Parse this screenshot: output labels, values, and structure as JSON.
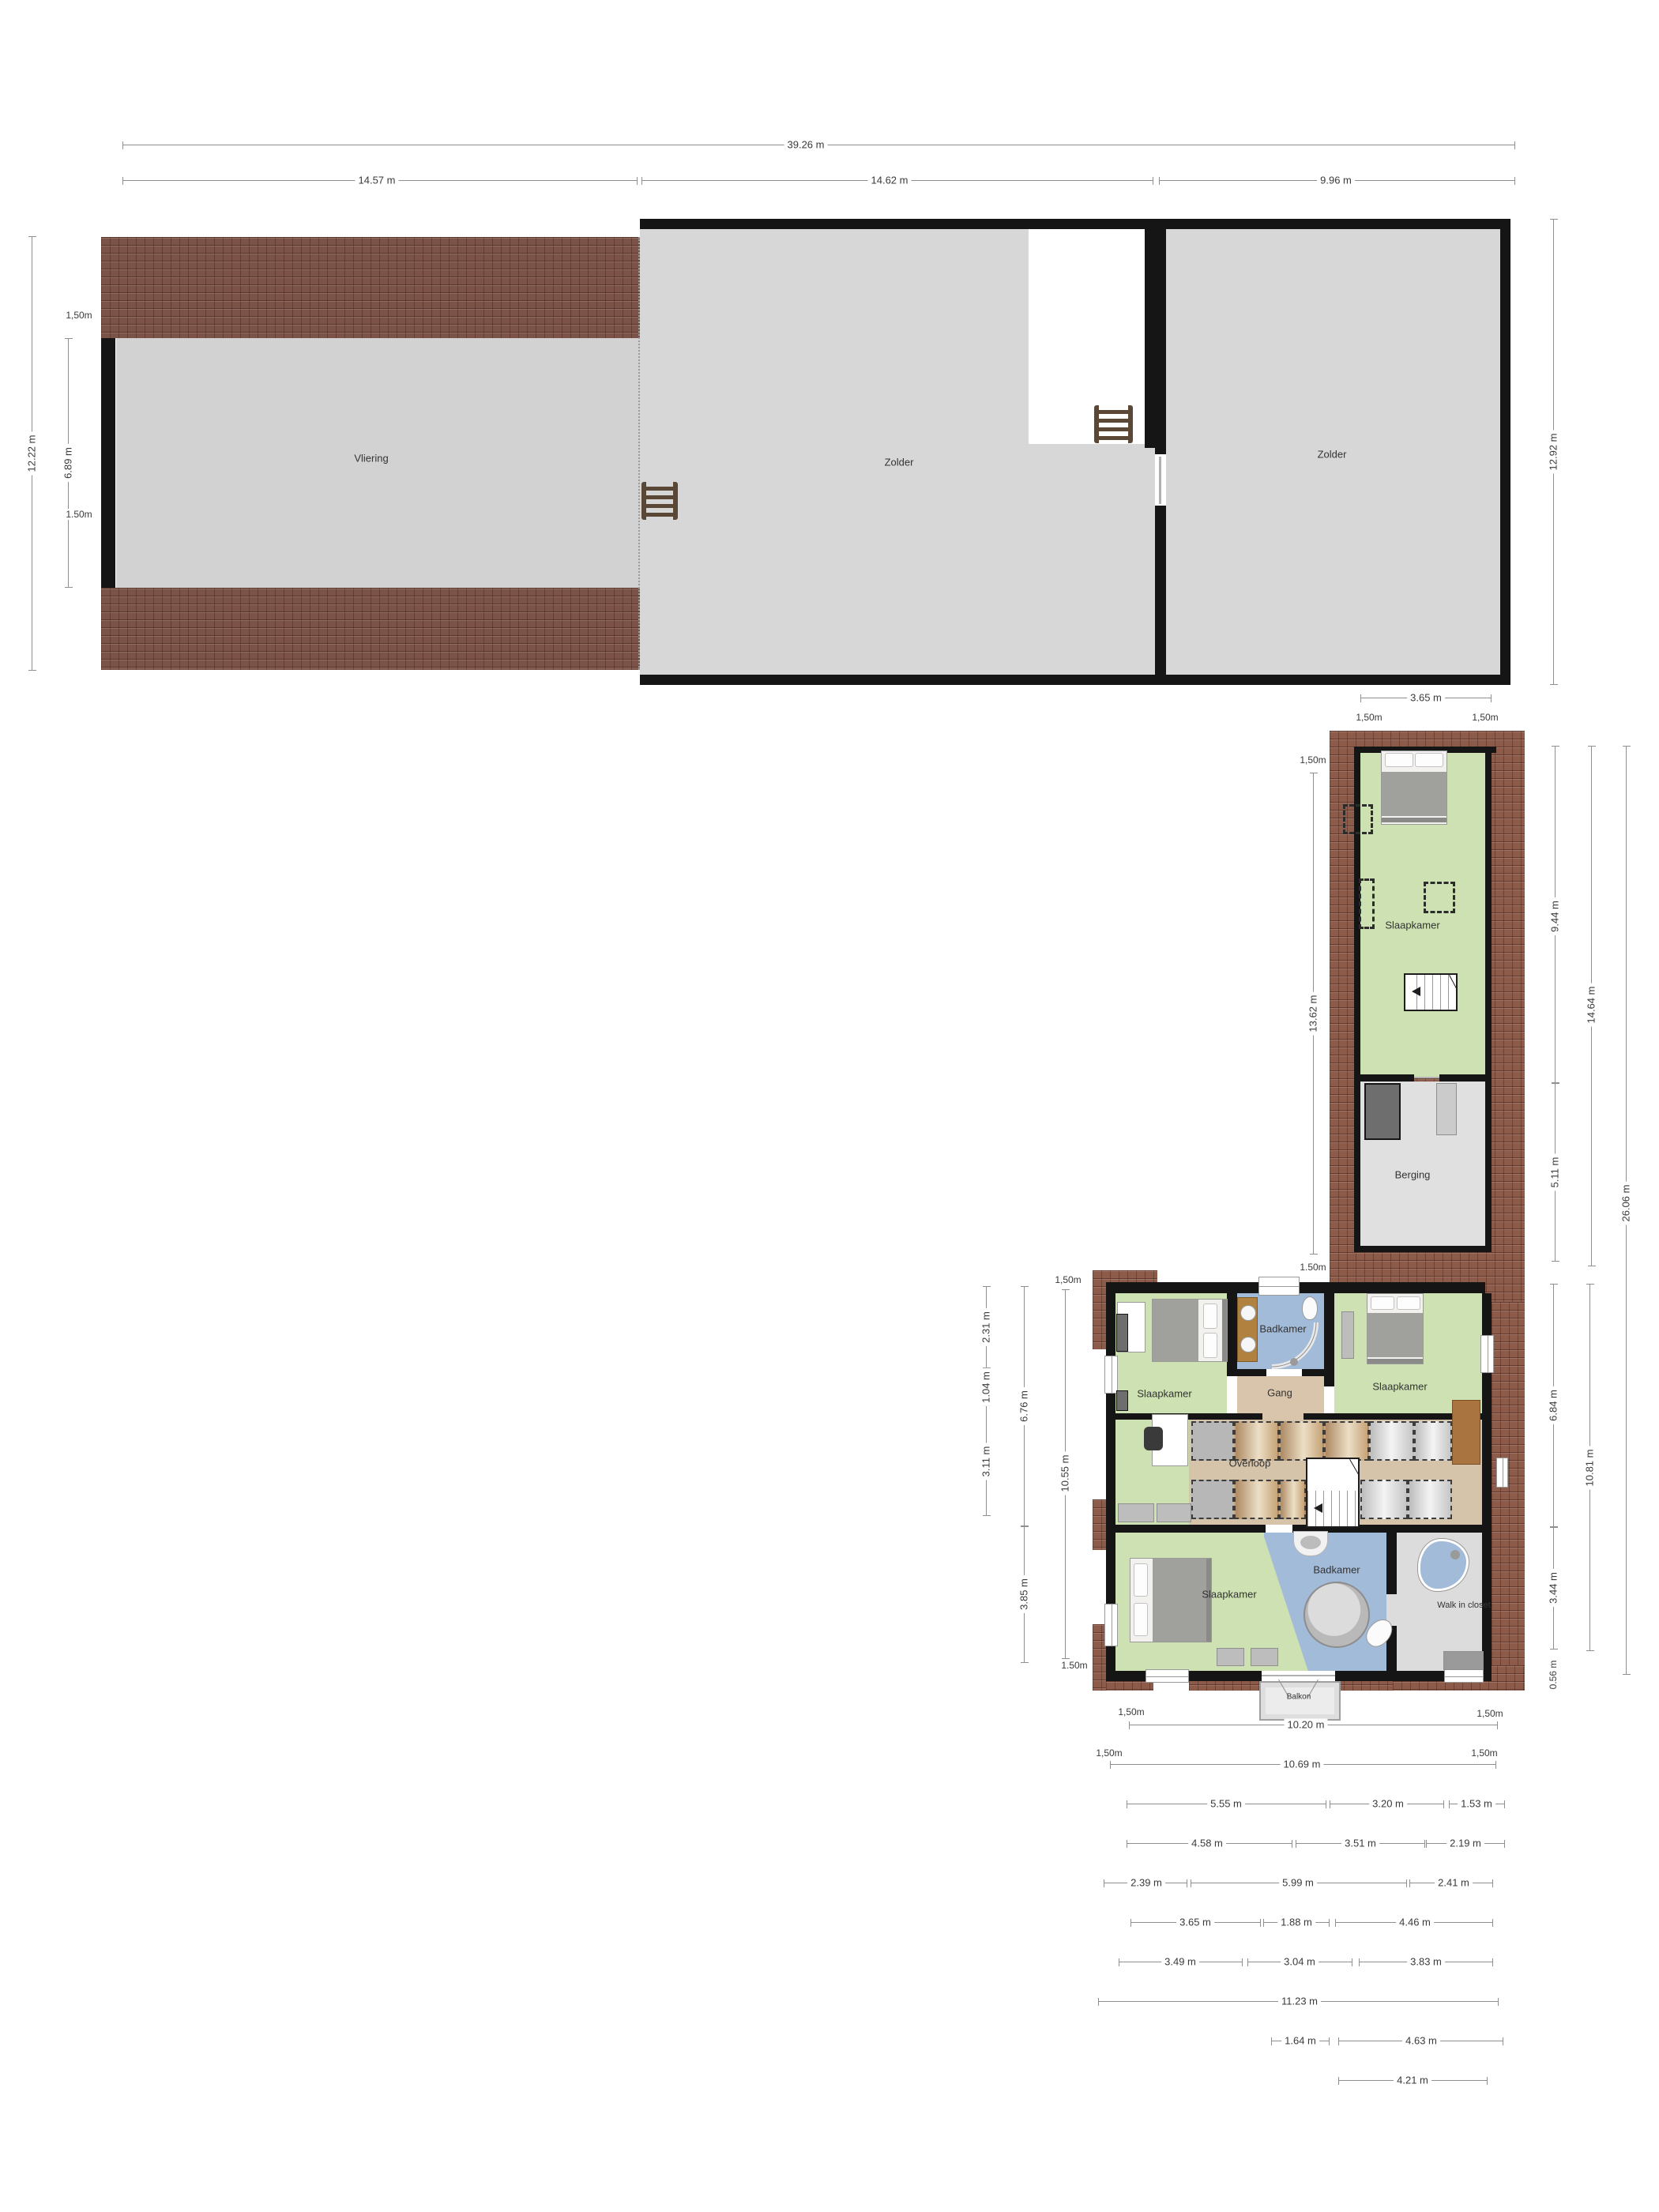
{
  "attic": {
    "label_vliering": "Vliering",
    "label_zolder_mid": "Zolder",
    "label_zolder_right": "Zolder",
    "dim_total": "39.26 m",
    "dim_seg1": "14.57 m",
    "dim_seg2": "14.62 m",
    "dim_seg3": "9.96 m",
    "dim_left_overall": "12.22 m",
    "dim_left_top": "1,50m",
    "dim_left_inner": "6.89 m",
    "dim_left_bottom": "1.50m",
    "dim_right": "12.92 m"
  },
  "wing": {
    "label_slaapkamer": "Slaapkamer",
    "label_berging": "Berging",
    "dim_top": "3.65 m",
    "dim_top_left": "1,50m",
    "dim_top_right": "1,50m",
    "dim_left_top": "1,50m",
    "dim_left": "13.62 m",
    "dim_left_bottom": "1.50m",
    "dim_right_room": "9.44 m",
    "dim_right_berging": "5.11 m",
    "dim_right_wing": "14.64 m",
    "dim_right_total": "26.06 m"
  },
  "floor": {
    "label_slaapkamer_tl": "Slaapkamer",
    "label_badkamer_top": "Badkamer",
    "label_gang": "Gang",
    "label_slaapkamer_tr": "Slaapkamer",
    "label_overloop": "Overloop",
    "label_slaapkamer_bottom": "Slaapkamer",
    "label_badkamer_bottom": "Badkamer",
    "label_walkincloset": "Walk in closet",
    "label_balkon": "Balkon",
    "dim_left_outer": [
      "2.31 m",
      "1.04 m",
      "3.11 m"
    ],
    "dim_left_mid": [
      "6.76 m",
      "3.85 m"
    ],
    "dim_left_inner_top": "1,50m",
    "dim_left_inner": "10.55 m",
    "dim_left_inner_bottom": "1.50m",
    "dim_right_inner_top": "6.84 m",
    "dim_right_inner_bottom": "3.44 m",
    "dim_right_small": "0.56 m",
    "dim_right_mid": "10.81 m",
    "rows": {
      "r1_left": "1,50m",
      "r1": "10.20 m",
      "r1_right": "1,50m",
      "r2_left": "1,50m",
      "r2": "10.69 m",
      "r2_right": "1,50m",
      "r3": [
        "5.55 m",
        "3.20 m",
        "1.53 m"
      ],
      "r4": [
        "4.58 m",
        "3.51 m",
        "2.19 m"
      ],
      "r5": [
        "2.39 m",
        "5.99 m",
        "2.41 m"
      ],
      "r6": [
        "3.65 m",
        "1.88 m",
        "4.46 m"
      ],
      "r7": [
        "3.49 m",
        "3.04 m",
        "3.83 m"
      ],
      "r8": "11.23 m",
      "r9": [
        "1.64 m",
        "4.63 m"
      ],
      "r10": "4.21 m"
    }
  }
}
